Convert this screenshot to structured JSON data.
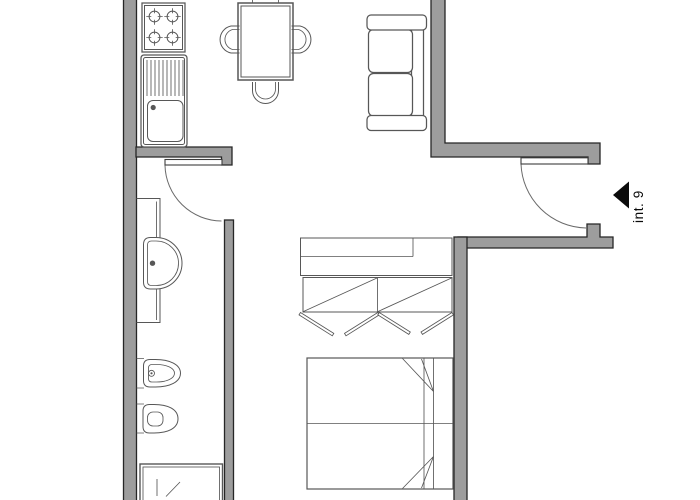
{
  "page": {
    "title": "int. 9"
  },
  "theme": {
    "bg": "#ffffff",
    "wall-fill": "#9d9d9d",
    "wall-edge": "#262626",
    "line": "#575757",
    "door": "#3d3d3d",
    "arc": "#6a6a6a",
    "ink": "#0b0b0b"
  },
  "entrance": {
    "unit_label": "int. 9",
    "arrow_icon": "entrance-arrow-icon",
    "arrow_direction": "left"
  },
  "fixtures": [
    {
      "name": "stove",
      "burners": 4
    },
    {
      "name": "kitchen-sink-with-drainboard"
    },
    {
      "name": "dining-table",
      "chairs": 4
    },
    {
      "name": "sofa",
      "seats": 2
    },
    {
      "name": "entrance-door"
    },
    {
      "name": "bathroom-door"
    },
    {
      "name": "vanity-counter"
    },
    {
      "name": "washbasin"
    },
    {
      "name": "bidet"
    },
    {
      "name": "toilet"
    },
    {
      "name": "shower"
    },
    {
      "name": "shelf-unit"
    },
    {
      "name": "wardrobe"
    },
    {
      "name": "double-bed"
    }
  ]
}
